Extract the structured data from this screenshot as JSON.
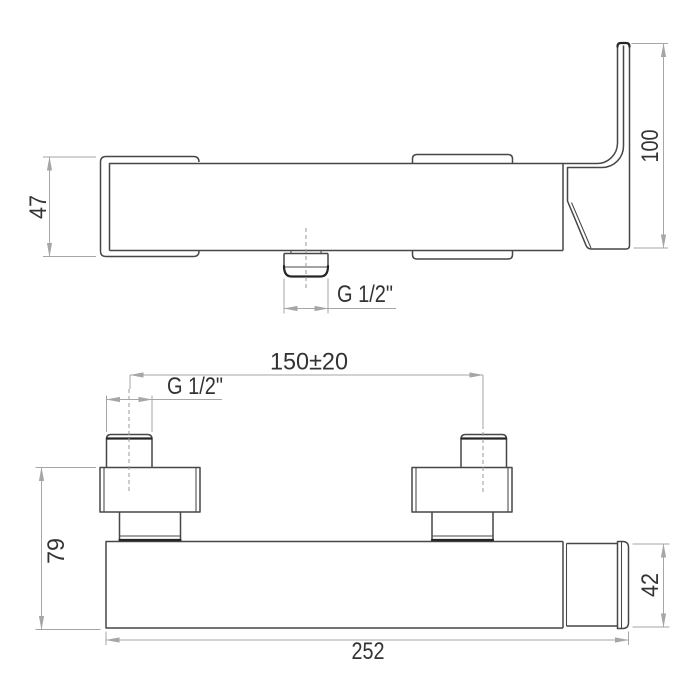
{
  "front_view": {
    "escutcheon_height": "47",
    "handle_height": "100",
    "outlet_thread": "G 1/2\""
  },
  "top_view": {
    "inlet_spacing": "150±20",
    "inlet_thread": "G 1/2\"",
    "depth": "79",
    "body_height": "42",
    "overall_width": "252"
  },
  "colors": {
    "outline": "#474747",
    "heavy": "#262626",
    "dimension": "#a6a6a6",
    "centerline": "#999999",
    "text": "#333333",
    "background": "#ffffff"
  }
}
